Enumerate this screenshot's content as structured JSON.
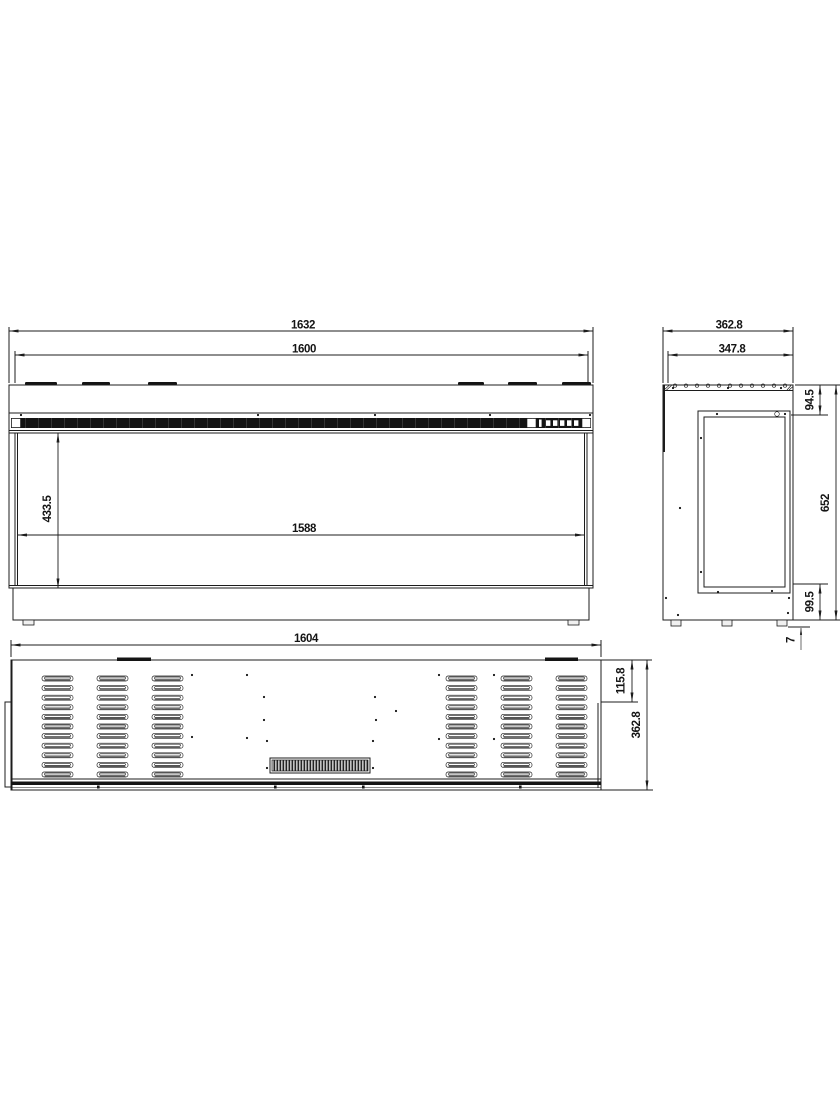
{
  "background": "#ffffff",
  "line_color": "#1c1c1c",
  "views": {
    "front": {
      "label_overall_width": "1632",
      "label_frame_width": "1600",
      "label_opening_width": "1588",
      "label_opening_height": "433.5"
    },
    "side": {
      "label_overall_depth": "362.8",
      "label_body_depth": "347.8",
      "label_top_section": "94.5",
      "label_overall_height": "652",
      "label_bottom_section": "99.5",
      "label_foot_height": "7"
    },
    "rear": {
      "label_width": "1604",
      "label_side_offset": "115.8",
      "label_height": "362.8"
    }
  }
}
